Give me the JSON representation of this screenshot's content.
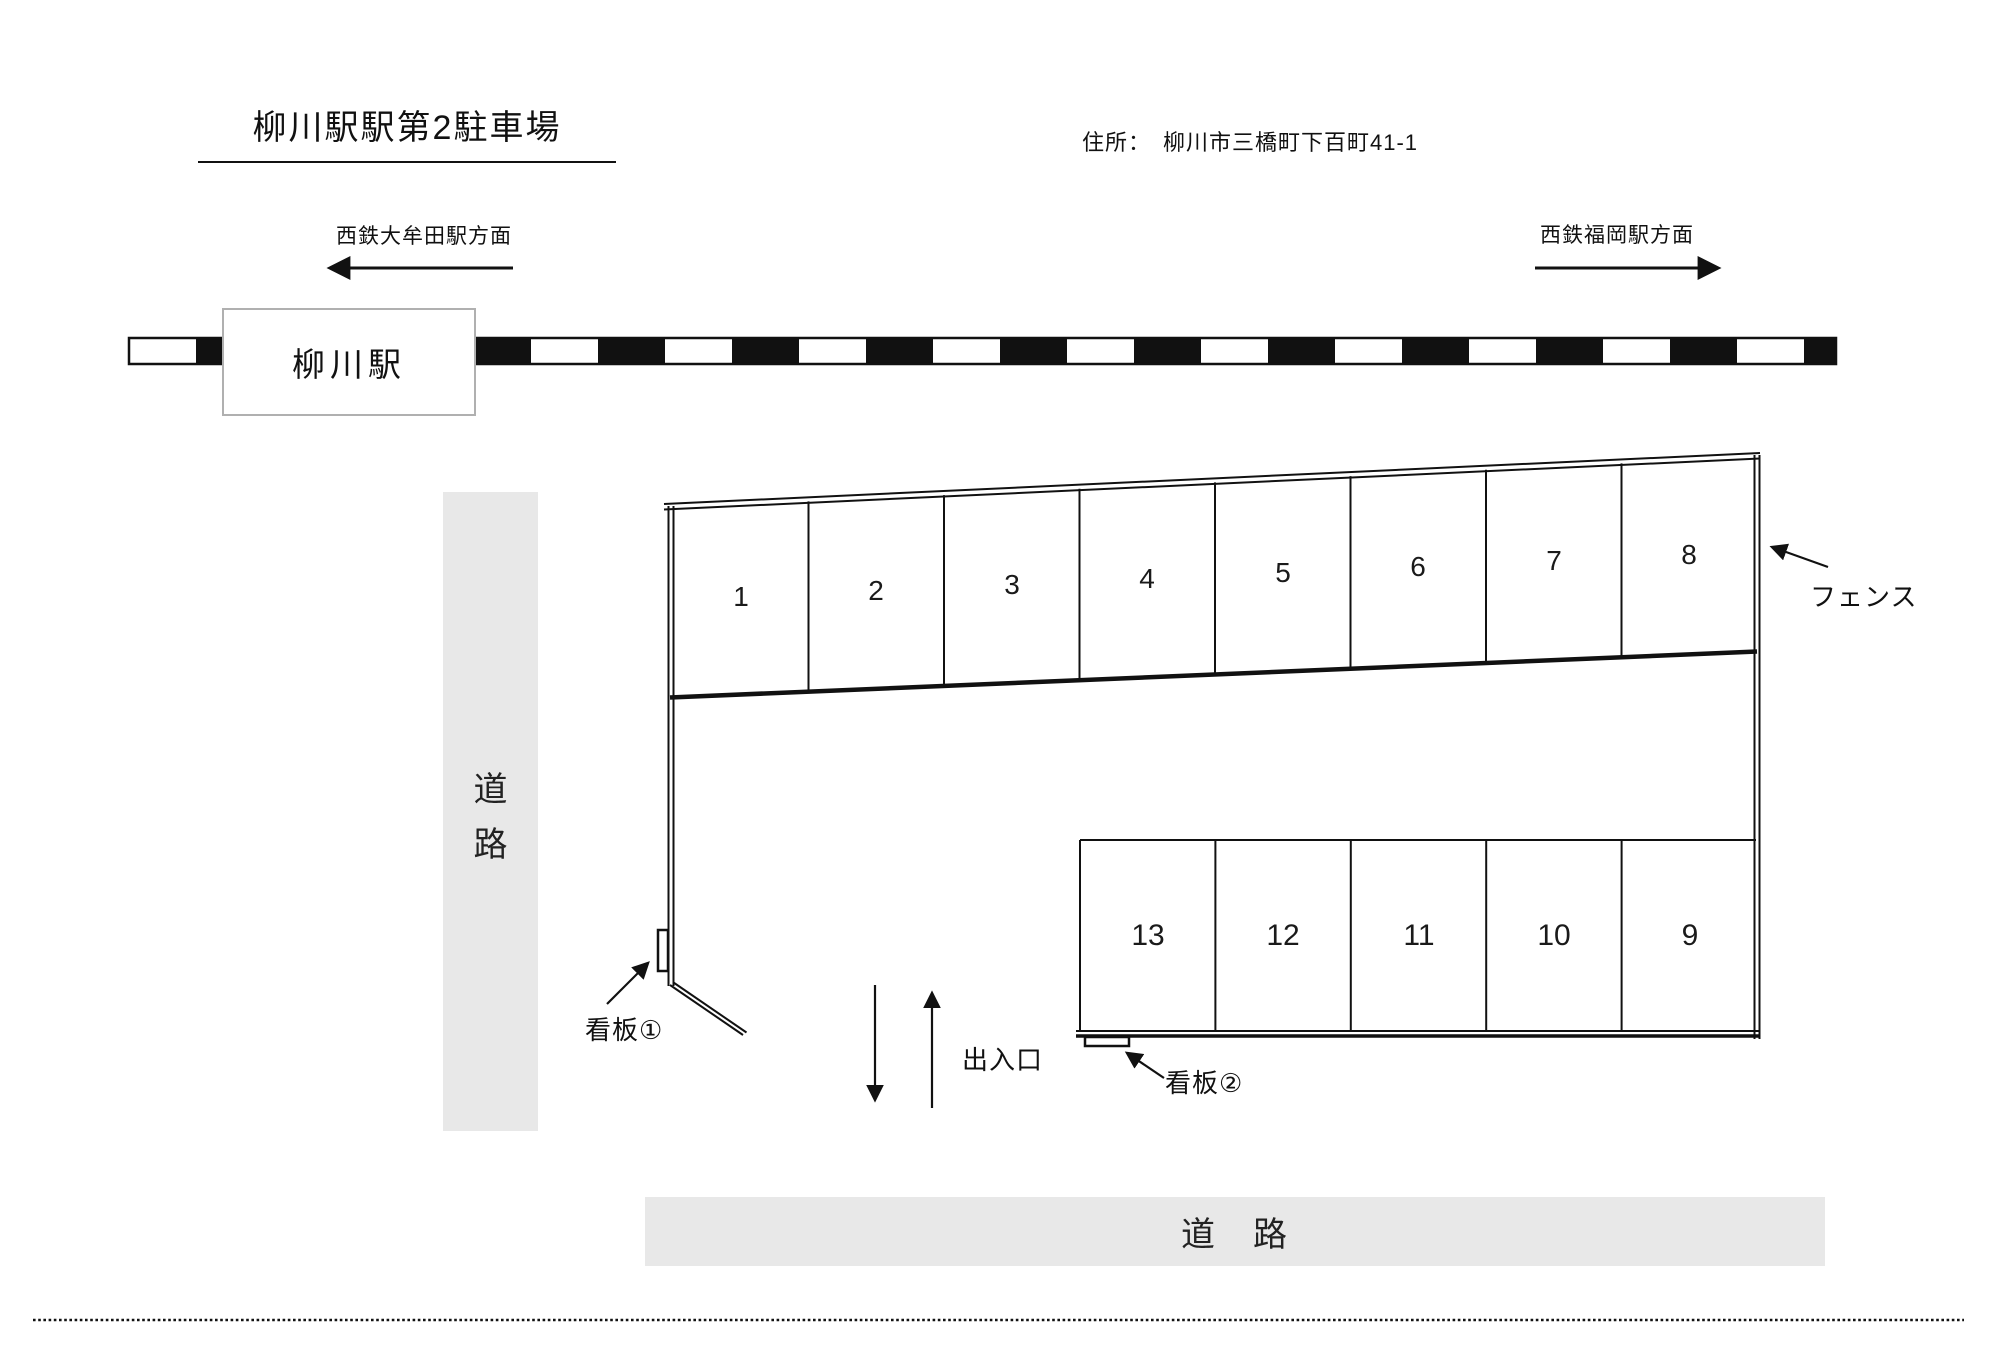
{
  "title": "柳川駅駅第2駐車場",
  "address": "住所：　柳川市三橋町下百町41-1",
  "directions": {
    "left": "西鉄大牟田駅方面",
    "right": "西鉄福岡駅方面"
  },
  "station": {
    "name": "柳川駅"
  },
  "roads": {
    "left_vertical": [
      "道",
      "路"
    ],
    "bottom": "道　路"
  },
  "lot": {
    "top_row_spaces": [
      "1",
      "2",
      "3",
      "4",
      "5",
      "6",
      "7",
      "8"
    ],
    "bottom_row_spaces": [
      "13",
      "12",
      "11",
      "10",
      "9"
    ],
    "fence_label": "フェンス",
    "sign1_label": "看板①",
    "sign2_label": "看板②",
    "entrance_label": "出入口"
  },
  "colors": {
    "line": "#111111",
    "road_fill": "#e8e8e8",
    "station_border": "#b0b0b0",
    "rail_black": "#111111",
    "background": "#ffffff"
  }
}
